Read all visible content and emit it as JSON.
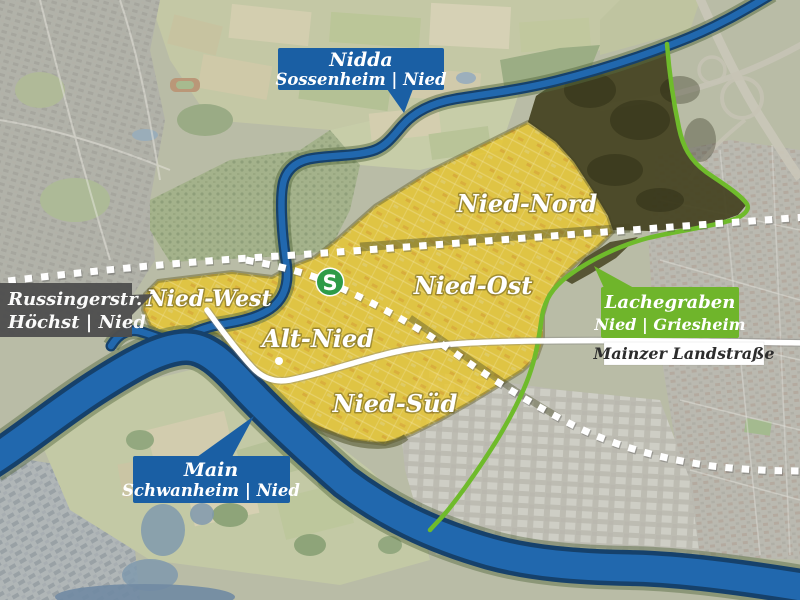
{
  "map": {
    "title": "Nied district map (Frankfurt) with neighbouring boundaries",
    "region_labels": {
      "nied_nord": "Nied-Nord",
      "nied_ost": "Nied-Ost",
      "nied_west": "Nied-West",
      "alt_nied": "Alt-Nied",
      "nied_sued": "Nied-Süd"
    },
    "callouts": {
      "nidda": {
        "line1": "Nidda",
        "line2": "Sossenheim | Nied"
      },
      "russingerstr": {
        "line1": "Russingerstr.",
        "line2": "Höchst | Nied"
      },
      "lachegraben": {
        "line1": "Lachegraben",
        "line2": "Nied | Griesheim"
      },
      "main": {
        "line1": "Main",
        "line2": "Schwanheim | Nied"
      }
    },
    "street_label": "Mainzer Landstraße",
    "sbahn_symbol": "S",
    "colors": {
      "callout_blue": "#1a5fa4",
      "callout_dark": "#4e4e4e",
      "callout_green": "#6fb52b",
      "boundary_green": "#6fbb2b",
      "district_yellow": "#e8c62e",
      "waterway_fill": "#2168ae",
      "waterway_casing": "#16416b",
      "railway_white": "#ffffff",
      "sbahn_green": "#2e9b47",
      "street_box_white": "#ffffff"
    }
  }
}
